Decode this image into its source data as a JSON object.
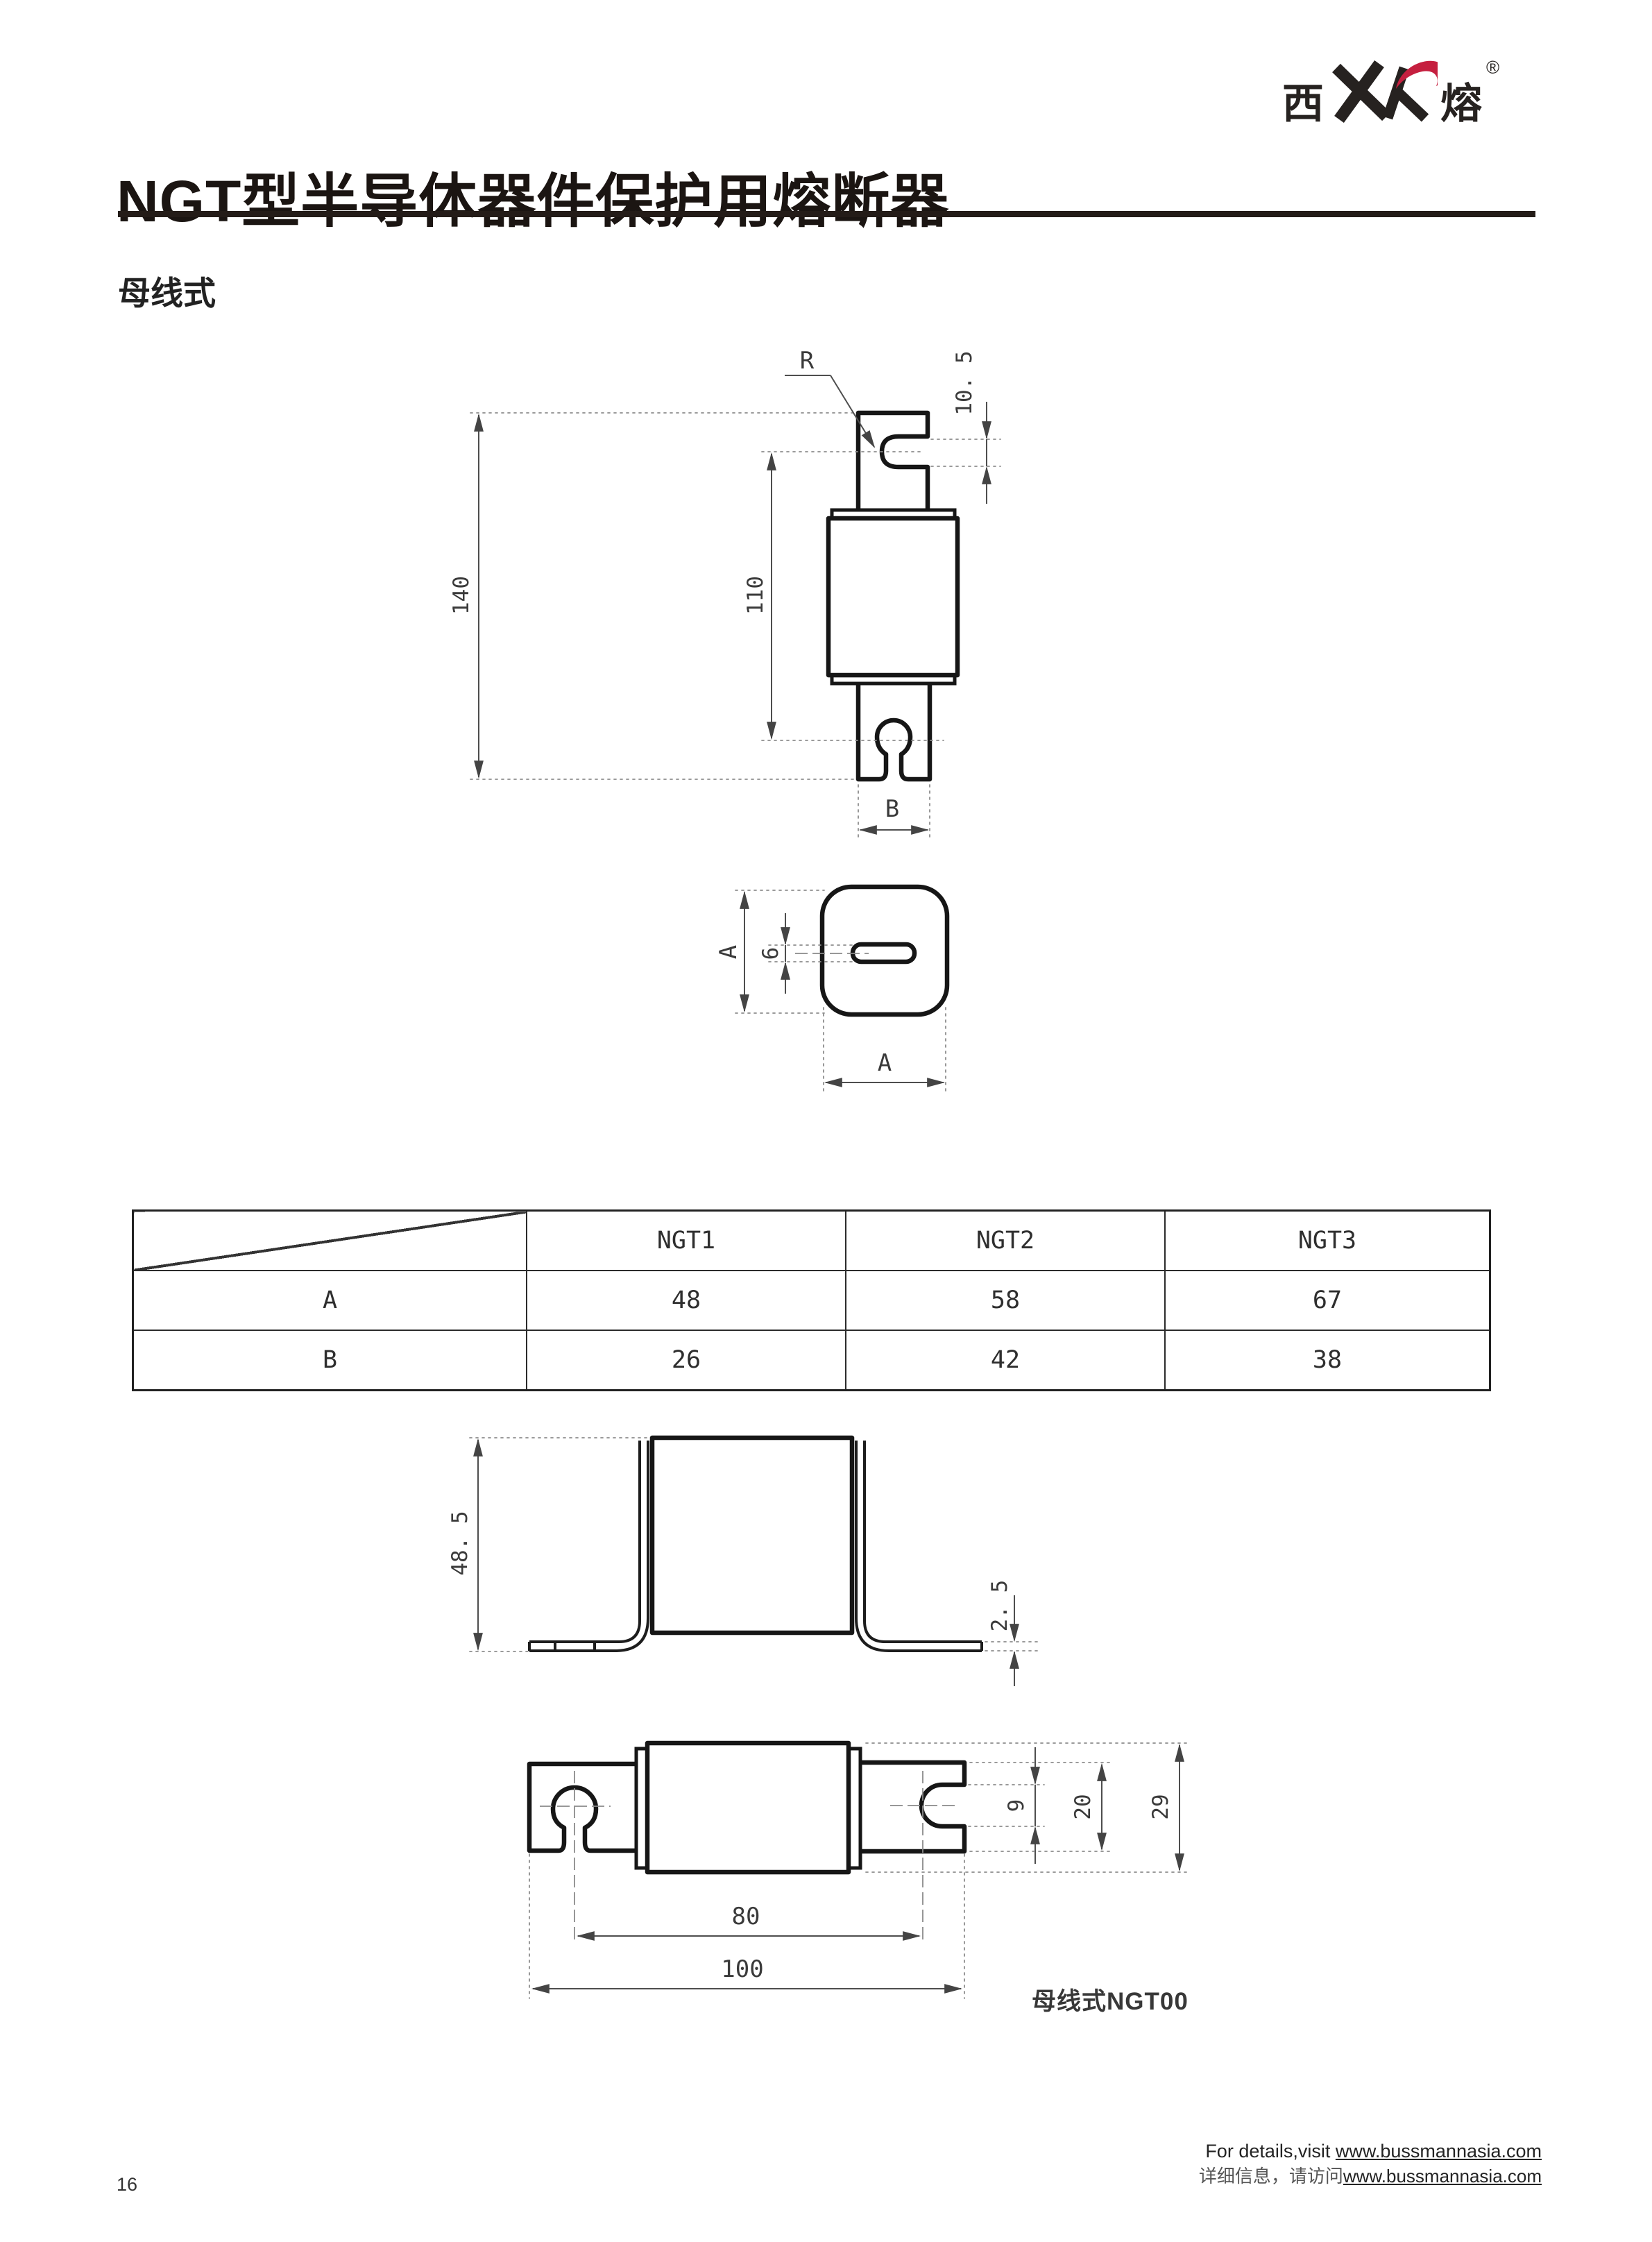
{
  "logo": {
    "cn_left": "西",
    "mark": "XR",
    "cn_right": "熔",
    "registered": "®",
    "accent_color": "#c51f3f",
    "ink_color": "#262220"
  },
  "header": {
    "title": "NGT型半导体器件保护用熔断器",
    "subtitle": "母线式"
  },
  "table": {
    "columns": [
      "NGT1",
      "NGT2",
      "NGT3"
    ],
    "rows": [
      {
        "label": "A",
        "values": [
          "48",
          "58",
          "67"
        ]
      },
      {
        "label": "B",
        "values": [
          "26",
          "42",
          "38"
        ]
      }
    ]
  },
  "drawings": {
    "front_view": {
      "radius_label": "R",
      "slot_height": "10. 5",
      "overall_height": "140",
      "inner_span": "110",
      "blade_width": "B"
    },
    "top_view": {
      "side": "A",
      "slot_width": "6",
      "width": "A"
    },
    "bracket_view": {
      "height": "48. 5",
      "foot_thickness": "2. 5"
    },
    "horizontal_view": {
      "notch_height": "9",
      "blade_height": "20",
      "body_height": "29",
      "inner_length": "80",
      "overall_length": "100",
      "caption": "母线式NGT00"
    }
  },
  "footer": {
    "line1_prefix": "For details,visit ",
    "line1_link": "www.bussmannasia.com",
    "line2_prefix": "详细信息，请访问",
    "line2_link": "www.bussmannasia.com"
  },
  "page": {
    "number": "16"
  }
}
